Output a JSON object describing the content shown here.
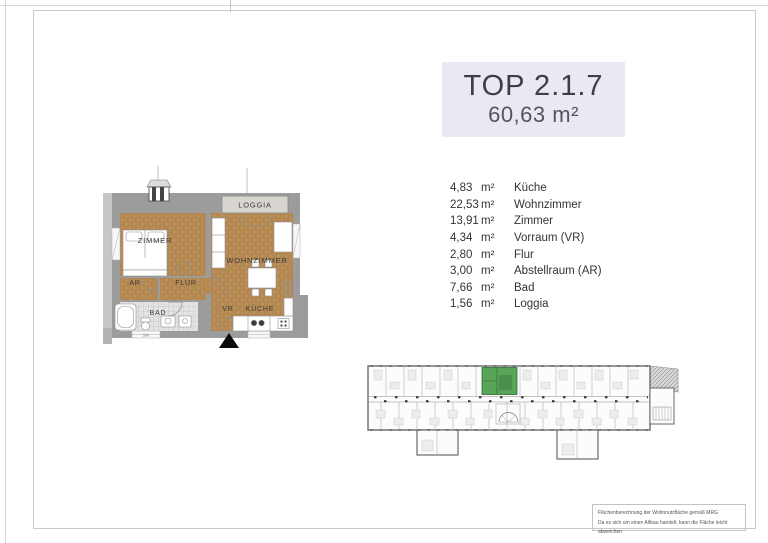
{
  "header": {
    "title": "TOP 2.1.7",
    "total_area": "60,63 m²"
  },
  "room_list": [
    {
      "area": "4,83",
      "unit": "m²",
      "name": "Küche"
    },
    {
      "area": "22,53",
      "unit": "m²",
      "name": "Wohnzimmer"
    },
    {
      "area": "13,91",
      "unit": "m²",
      "name": "Zimmer"
    },
    {
      "area": "4,34",
      "unit": "m²",
      "name": "Vorraum (VR)"
    },
    {
      "area": "2,80",
      "unit": "m²",
      "name": "Flur"
    },
    {
      "area": "3,00",
      "unit": "m²",
      "name": "Abstellraum (AR)"
    },
    {
      "area": "7,66",
      "unit": "m²",
      "name": "Bad"
    },
    {
      "area": "1,56",
      "unit": "m²",
      "name": "Loggia"
    }
  ],
  "floorplan": {
    "labels": {
      "zimmer": "ZIMMER",
      "wohnzimmer": "WOHNZIMMER",
      "loggia": "LOGGIA",
      "ar": "AR",
      "flur": "FLUR",
      "bad": "BAD",
      "vr": "VR",
      "kueche": "KÜCHE"
    },
    "dimension": "500",
    "colors": {
      "wood": "#b78a52",
      "wall": "#9c9c9c",
      "tile": "#e3e3e3",
      "highlight": "#58a458"
    }
  },
  "footer": {
    "line1": "Flächenberechnung der Wohnnutzfläche gemäß MRG",
    "line2": "Da es sich um einen Altbau handelt, kann die Fläche leicht abweichen"
  }
}
